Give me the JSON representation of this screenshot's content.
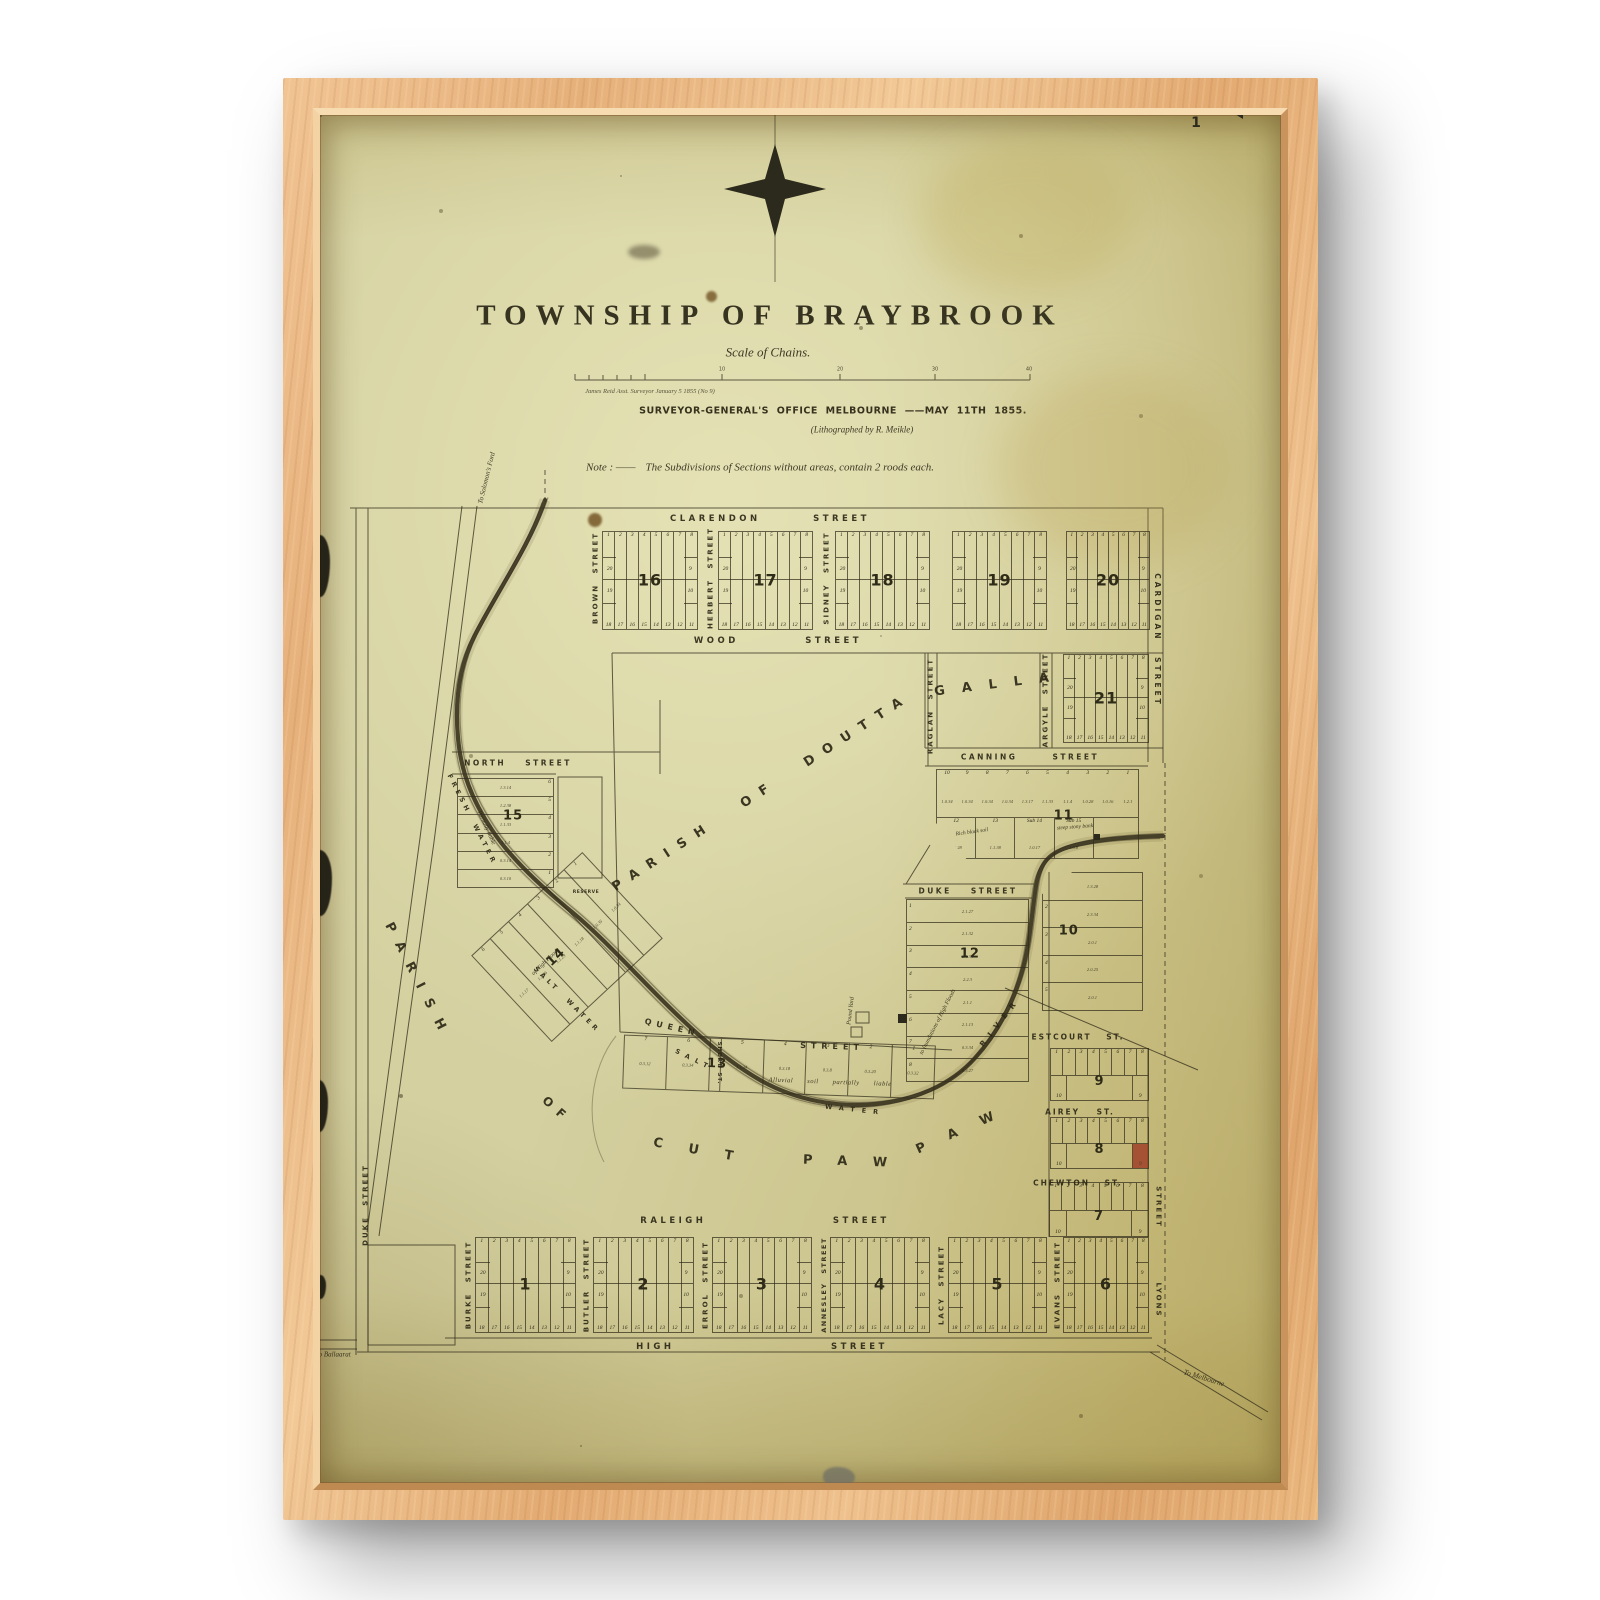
{
  "artwork": {
    "title": "TOWNSHIP OF BRAYBROOK",
    "scale_caption": "Scale of Chains.",
    "surveyor_note": "James Reid  Asst. Surveyor  January 5 1855  (No 9)",
    "office_line": "SURVEYOR-GENERAL'S OFFICE MELBOURNE ——MAY 11TH 1855.",
    "litho_line": "(Lithographed by R. Meikle)",
    "note_label": "Note : ——",
    "note_text": "The Subdivisions of Sections without areas, contain 2 roods each.",
    "page_number": "1",
    "scale_ticks": [
      "10",
      "20",
      "30",
      "40"
    ]
  },
  "map": {
    "parish_north": "PARISH OF DOUTTA GALLA",
    "parish_south": "PARISH OF CUT PAW PAW",
    "streets": [
      {
        "id": "clarendon",
        "text": "CLARENDON STREET"
      },
      {
        "id": "wood",
        "text": "WOOD STREET"
      },
      {
        "id": "north",
        "text": "NORTH STREET"
      },
      {
        "id": "canning",
        "text": "CANNING STREET"
      },
      {
        "id": "duke_h",
        "text": "DUKE STREET"
      },
      {
        "id": "queen",
        "text": "QUEEN"
      },
      {
        "id": "queen_st",
        "text": "STREET"
      },
      {
        "id": "raleigh",
        "text": "RALEIGH STREET"
      },
      {
        "id": "high",
        "text": "HIGH STREET"
      },
      {
        "id": "estcourt",
        "text": "ESTCOURT ST."
      },
      {
        "id": "airey",
        "text": "AIREY ST."
      },
      {
        "id": "chewton",
        "text": "CHEWTON ST."
      },
      {
        "id": "brown",
        "text": "BROWN STREET"
      },
      {
        "id": "herbert",
        "text": "HERBERT STREET"
      },
      {
        "id": "sidney",
        "text": "SIDNEY STREET"
      },
      {
        "id": "raglan",
        "text": "RAGLAN STREET"
      },
      {
        "id": "argyle",
        "text": "ARGYLE STREET"
      },
      {
        "id": "cardigan",
        "text": "CARDIGAN STREET"
      },
      {
        "id": "burke",
        "text": "BURKE STREET"
      },
      {
        "id": "butler",
        "text": "BUTLER STREET"
      },
      {
        "id": "errol",
        "text": "ERROL STREET"
      },
      {
        "id": "annesley",
        "text": "ANNESLEY STREET"
      },
      {
        "id": "lacy",
        "text": "LACY STREET"
      },
      {
        "id": "evans",
        "text": "EVANS STREET"
      },
      {
        "id": "lyons",
        "text": "LYONS"
      },
      {
        "id": "lyons_st",
        "text": "STREET"
      },
      {
        "id": "duke_v",
        "text": "DUKE STREET"
      },
      {
        "id": "short_st",
        "text": "SHORT ST."
      }
    ],
    "annotations": [
      {
        "id": "doutta",
        "text": "PARISH OF DOUTTA"
      },
      {
        "id": "galla",
        "text": "GALLA"
      },
      {
        "id": "parish_w",
        "text": "PARISH"
      },
      {
        "id": "of_w",
        "text": "OF"
      },
      {
        "id": "cut",
        "text": "CUT"
      },
      {
        "id": "paw1",
        "text": "PAW"
      },
      {
        "id": "paw2",
        "text": "PAW"
      },
      {
        "id": "fresh_water",
        "text": "FRESH WATER"
      },
      {
        "id": "salt_water1",
        "text": "SALT WATER"
      },
      {
        "id": "salt2",
        "text": "SALT"
      },
      {
        "id": "water2",
        "text": "WATER"
      },
      {
        "id": "river_ne",
        "text": "RIVER"
      },
      {
        "id": "pound",
        "text": "Pound Yard"
      },
      {
        "id": "alluvial",
        "text": "Alluvial soil partially liable"
      },
      {
        "id": "inund1",
        "text": "to Inundations of High Floods"
      },
      {
        "id": "part_liable",
        "text": "Partially liable"
      },
      {
        "id": "high_floods",
        "text": "of High Floods"
      },
      {
        "id": "rich_black",
        "text": "Rich black soil"
      },
      {
        "id": "steep",
        "text": "steep stony bank"
      },
      {
        "id": "reserve",
        "text": "RESERVE"
      },
      {
        "id": "solomons",
        "text": "To Solomon's Ford"
      },
      {
        "id": "ballaarat",
        "text": "To Ballaarat"
      },
      {
        "id": "melbourne",
        "text": "To Melbourne"
      }
    ],
    "sections": {
      "lot_pattern": {
        "top": [
          "1",
          "2",
          "3",
          "4",
          "5",
          "6",
          "7",
          "8"
        ],
        "left": [
          "20",
          "19"
        ],
        "right": [
          "9",
          "10"
        ],
        "bottom": [
          "18",
          "17",
          "16",
          "15",
          "14",
          "13",
          "12",
          "11"
        ]
      },
      "standard": [
        "16",
        "17",
        "18",
        "19",
        "20",
        "21",
        "1",
        "2",
        "3",
        "4",
        "5",
        "6"
      ],
      "half": [
        {
          "number": "9"
        },
        {
          "number": "8",
          "highlight_lot": "9"
        },
        {
          "number": "7"
        }
      ],
      "strips": [
        {
          "id": "15",
          "number": "15",
          "lots": [
            "6",
            "5",
            "4",
            "3",
            "2",
            "1"
          ],
          "areas": [
            "1.3.14",
            "1.2.38",
            "1.1.33",
            "1.1.4",
            "0.3.14",
            "0.3.10"
          ]
        },
        {
          "id": "14",
          "number": "14",
          "lots": [
            "6",
            "5",
            "4",
            "3",
            "2",
            "1"
          ],
          "areas": [
            "1.1.17",
            "1.1.36",
            "1.1.29",
            "1.1.18",
            "1.0.35",
            "1.0.34"
          ]
        },
        {
          "id": "13",
          "number": "13",
          "lots": [
            "7",
            "6",
            "5",
            "4",
            "3",
            "2",
            "1"
          ],
          "areas": [
            "0.3.12",
            "0.3.34",
            "1.1.34",
            "0.3.18",
            "0.3.8",
            "0.3.20",
            "0.3.32"
          ]
        },
        {
          "id": "12",
          "number": "12",
          "lots": [
            "1",
            "2",
            "3",
            "4",
            "5",
            "6",
            "7",
            "8"
          ],
          "areas": [
            "2.1.27",
            "2.1.32",
            "2.1.34",
            "2.2.3",
            "2.1.1",
            "2.1.13",
            "0.3.34",
            "0.3.27"
          ]
        },
        {
          "id": "10",
          "number": "10",
          "lots": [
            "1",
            "2",
            "3",
            "4",
            "5"
          ],
          "areas": [
            "1.3.28",
            "2.3.34",
            "2.0.1",
            "2.0.25",
            "2.0.1"
          ]
        }
      ],
      "section11": {
        "number": "11",
        "lots_top": [
          "10",
          "9",
          "8",
          "7",
          "6",
          "5",
          "4",
          "3",
          "2",
          "1"
        ],
        "areas_top": [
          "1.0.34",
          "1.0.34",
          "1.0.34",
          "1.0.34",
          "1.3.17",
          "1.1.33",
          "1.1.4",
          "1.0.28",
          "1.0.16",
          "1.2.1"
        ],
        "lots_bottom": [
          "12",
          "13",
          "Sub 14",
          "Sub 15"
        ],
        "areas_bottom": [
          "1.0.28",
          "1.1.38",
          "1.0.17",
          "1.0.8"
        ]
      }
    },
    "colors": {
      "paper": "#d4d0a0",
      "ink": "#34301e",
      "frame_wood": "#eab87f",
      "red_lot": "#9e3823"
    }
  }
}
